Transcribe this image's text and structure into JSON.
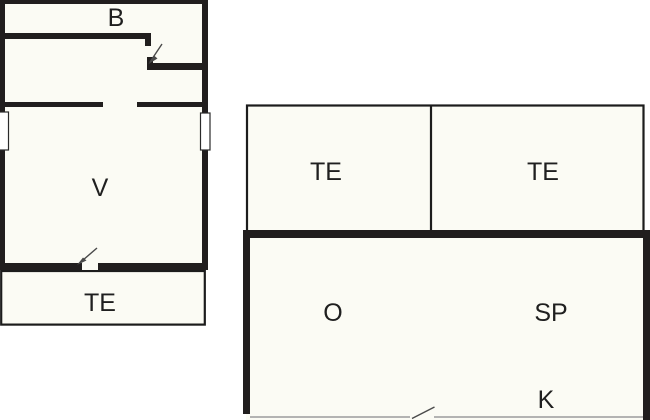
{
  "plan": {
    "type": "floor-plan",
    "background_color": "#ffffff",
    "floor_color": "#fbfbf4",
    "wall_color": "#211e1e",
    "door_line_color": "#4a4a4a",
    "label_color": "#1f1f1f",
    "buildings": {
      "left": {
        "rooms": {
          "b": {
            "label": "B"
          },
          "v": {
            "label": "V"
          },
          "te": {
            "label": "TE"
          }
        }
      },
      "right": {
        "rooms": {
          "te1": {
            "label": "TE"
          },
          "te2": {
            "label": "TE"
          },
          "o": {
            "label": "O"
          },
          "sp": {
            "label": "SP"
          },
          "k": {
            "label": "K"
          }
        }
      }
    }
  }
}
